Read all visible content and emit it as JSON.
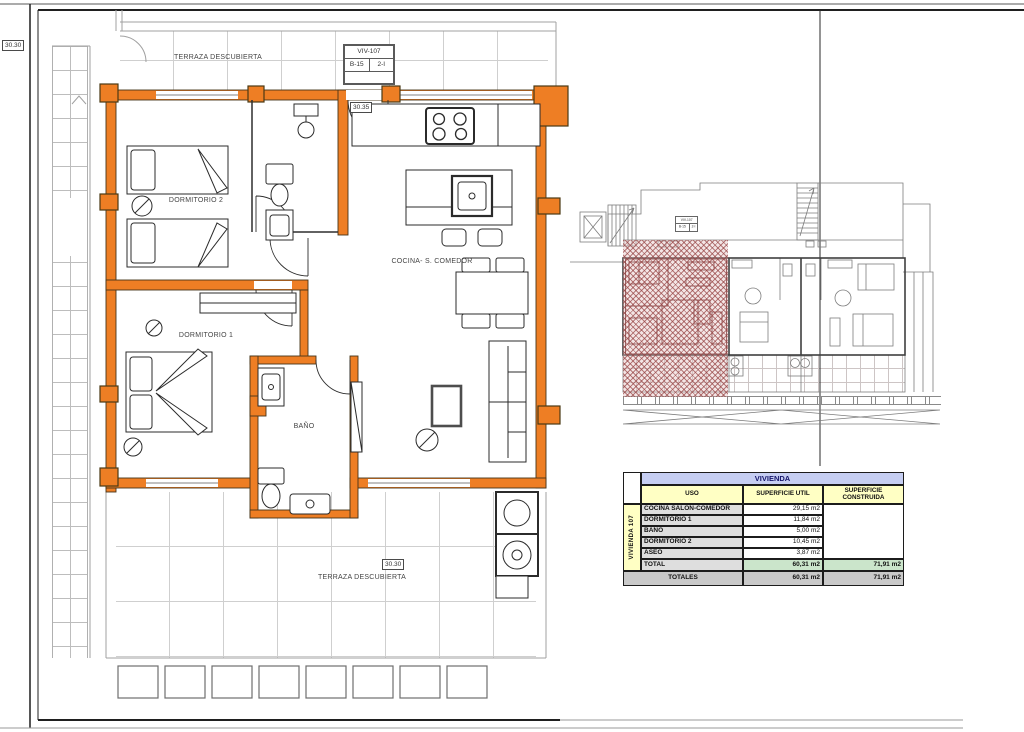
{
  "sheet": {
    "ref_box": "30.30"
  },
  "title_block": {
    "unit": "VIV-107",
    "block": "B-15",
    "type": "2-I"
  },
  "plan": {
    "labels": {
      "terrace_top": "TERRAZA DESCUBIERTA",
      "terrace_bottom": "TERRAZA DESCUBIERTA",
      "dormitorio2": "DORMITORIO 2",
      "dormitorio1": "DORMITORIO 1",
      "cocina_comedor": "COCINA- S. COMEDOR",
      "bano": "BAÑO"
    },
    "dims": {
      "top": "30.35",
      "bottom": "30.30"
    }
  },
  "table": {
    "title": "VIVIENDA",
    "row_group_label": "VIVIENDA 107",
    "headers": {
      "uso": "USO",
      "util": "SUPERFICIE UTIL",
      "construida": "SUPERFICIE CONSTRUIDA"
    },
    "rows": [
      {
        "uso": "COCINA SALÓN-COMEDOR",
        "util": "29,15 m2"
      },
      {
        "uso": "DORMITORIO 1",
        "util": "11,84 m2"
      },
      {
        "uso": "BAÑO",
        "util": "5,00 m2"
      },
      {
        "uso": "DORMITORIO 2",
        "util": "10,45 m2"
      },
      {
        "uso": "ASEO",
        "util": "3,87 m2"
      }
    ],
    "total": {
      "label": "TOTAL",
      "util": "60,31 m2",
      "construida": "71,91 m2"
    },
    "totales": {
      "label": "TOTALES",
      "util": "60,31 m2",
      "construida": "71,91 m2"
    }
  },
  "colors": {
    "highlight_wall": "#EE7E24",
    "hatch_line": "#96433F",
    "table_title_bg": "#C6CEF2",
    "table_header_bg": "#FFFFC4",
    "total_bg": "#CBE5CB",
    "totales_bg": "#C9C9C9"
  }
}
